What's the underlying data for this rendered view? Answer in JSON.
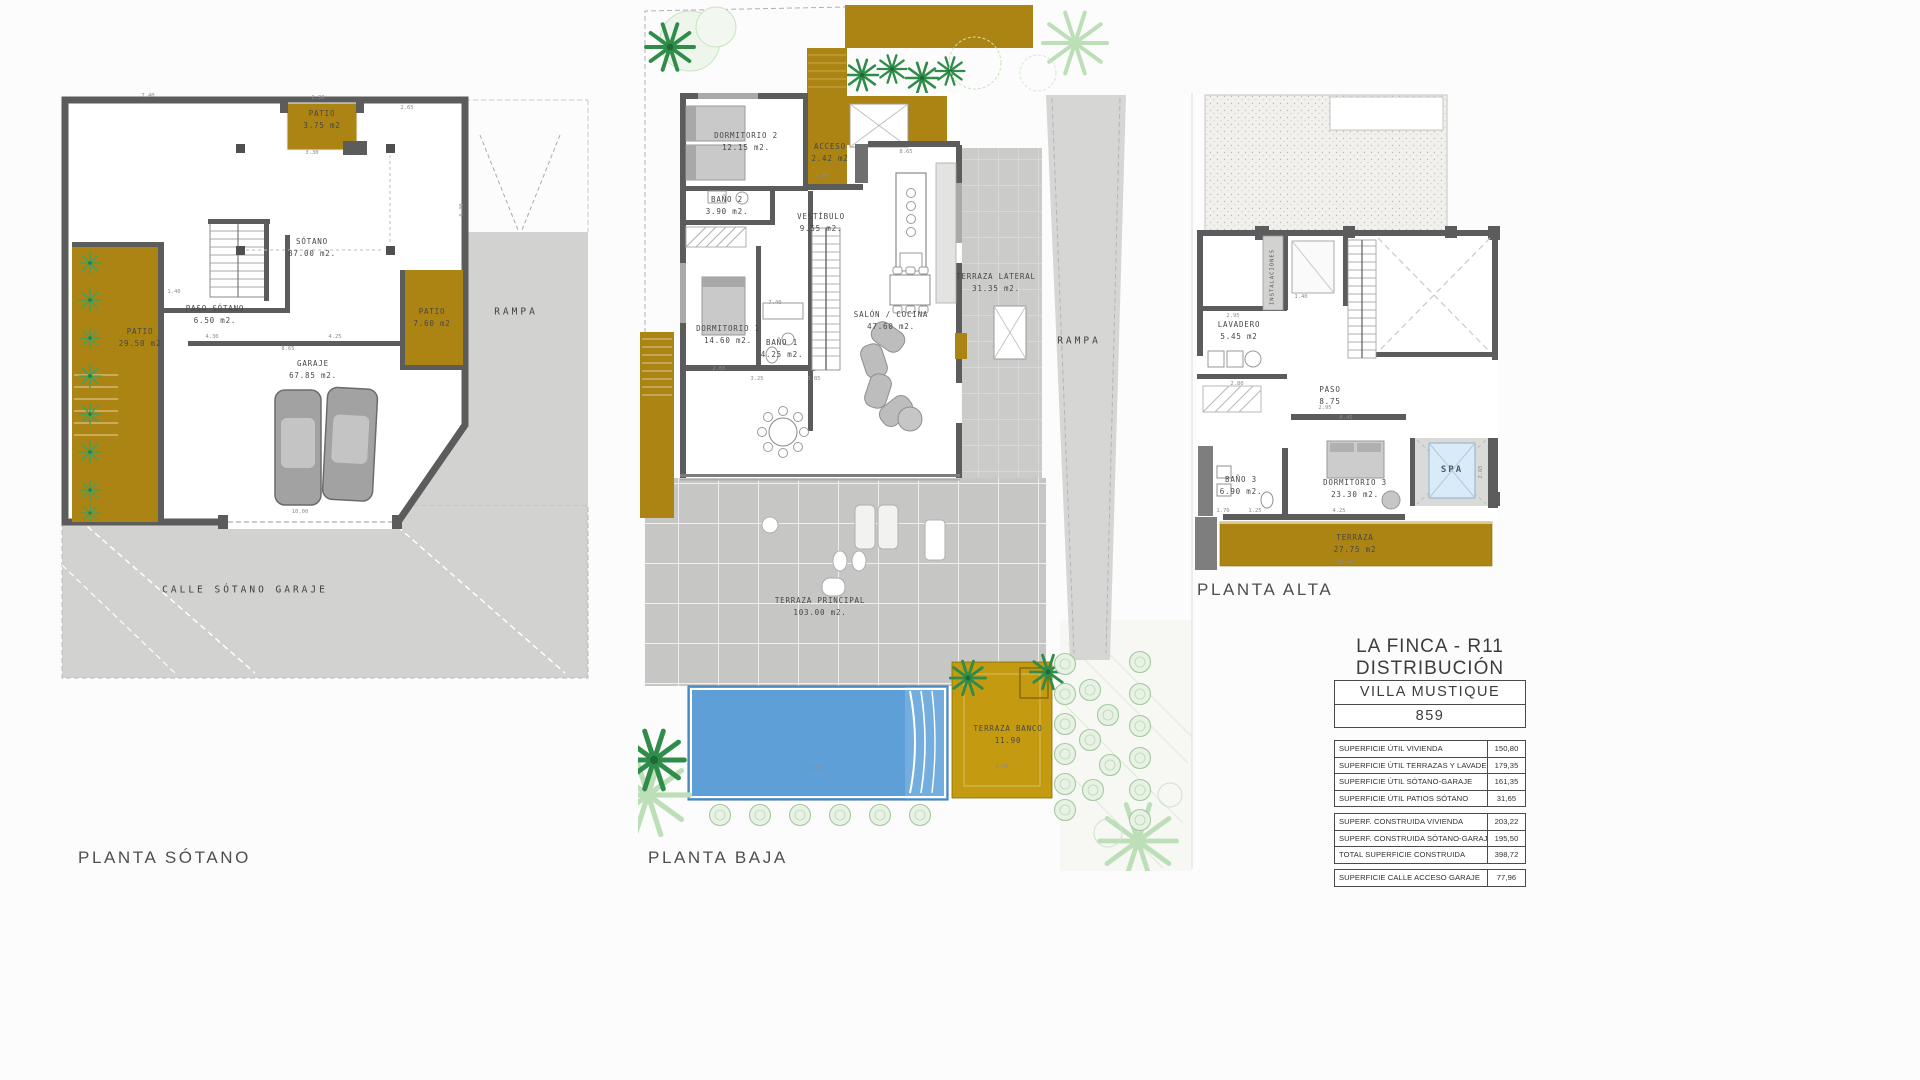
{
  "colors": {
    "ochre": "#ab8414",
    "ochre_bright": "#c49a10",
    "wall_gray": "#5c5c5c",
    "area_gray": "#d2d2d0",
    "tile_gray": "#c6c6c4",
    "pool_blue": "#5f9fd8",
    "spa_blue": "#d9ebf8",
    "plant_green": "#2f8c49",
    "text": "#3f3f3f"
  },
  "plans": {
    "sotano": {
      "title": "PLANTA SÓTANO",
      "rooms": {
        "patio_top": {
          "name": "PATIO",
          "area": "3.75 m2"
        },
        "sotano": {
          "name": "SÓTANO",
          "area": "87.00 m2."
        },
        "paso": {
          "name": "PASO SÓTANO",
          "area": "6.50 m2."
        },
        "patio_left": {
          "name": "PATIO",
          "area": "29.50 m2"
        },
        "patio_right": {
          "name": "PATIO",
          "area": "7.60 m2"
        },
        "garaje": {
          "name": "GARAJE",
          "area": "67.85 m2."
        },
        "rampa": {
          "name": "RAMPA"
        },
        "calle": {
          "name": "CALLE SÓTANO GARAJE"
        }
      }
    },
    "baja": {
      "title": "PLANTA BAJA",
      "rooms": {
        "dormitorio2": {
          "name": "DORMITORIO 2",
          "area": "12.15 m2."
        },
        "acceso": {
          "name": "ACCESO",
          "area": "2.42 m2"
        },
        "bano2": {
          "name": "BAÑO 2",
          "area": "3.90 m2."
        },
        "vestibulo": {
          "name": "VESTÍBULO",
          "area": "9.55 m2."
        },
        "dormitorio1": {
          "name": "DORMITORIO 1",
          "area": "14.60 m2."
        },
        "bano1": {
          "name": "BAÑO 1",
          "area": "4.25 m2."
        },
        "salon": {
          "name": "SALÓN / COCINA",
          "area": "47.60 m2."
        },
        "terraza_lateral": {
          "name": "TERRAZA LATERAL",
          "area": "31.35 m2."
        },
        "rampa": {
          "name": "RAMPA"
        },
        "terraza_principal": {
          "name": "TERRAZA PRINCIPAL",
          "area": "103.00 m2."
        },
        "terraza_banco": {
          "name": "TERRAZA BANCO",
          "area": "11.90"
        }
      }
    },
    "alta": {
      "title": "PLANTA ALTA",
      "rooms": {
        "instalaciones": {
          "name": "INSTALACIONES"
        },
        "lavadero": {
          "name": "LAVADERO",
          "area": "5.45 m2"
        },
        "paso": {
          "name": "PASO",
          "area": "8.75"
        },
        "bano3": {
          "name": "BAÑO 3",
          "area": "6.90 m2."
        },
        "dormitorio3": {
          "name": "DORMITORIO 3",
          "area": "23.30 m2."
        },
        "spa": {
          "name": "SPA"
        },
        "terraza": {
          "name": "TERRAZA",
          "area": "27.75 m2"
        }
      }
    }
  },
  "title_block": {
    "project": "LA FINCA - R11",
    "subtitle": "DISTRIBUCIÓN",
    "villa_name": "VILLA  MUSTIQUE",
    "villa_number": "859",
    "util_table": {
      "rows": [
        {
          "label": "SUPERFICIE ÚTIL VIVIENDA",
          "value": "150,80"
        },
        {
          "label": "SUPERFICIE ÚTIL TERRAZAS Y LAVADERO",
          "value": "179,35"
        },
        {
          "label": "SUPERFICIE ÚTIL SÓTANO-GARAJE",
          "value": "161,35"
        },
        {
          "label": "SUPERFICIE ÚTIL PATIOS SÓTANO",
          "value": "31,65"
        }
      ]
    },
    "construida_table": {
      "rows": [
        {
          "label": "SUPERF. CONSTRUIDA VIVIENDA",
          "value": "203,22"
        },
        {
          "label": "SUPERF. CONSTRUIDA SÓTANO-GARAJE",
          "value": "195,50"
        },
        {
          "label": "TOTAL SUPERFICIE CONSTRUIDA",
          "value": "398,72"
        }
      ]
    },
    "calle_table": {
      "rows": [
        {
          "label": "SUPERFICIE CALLE ACCESO GARAJE",
          "value": "77,96"
        }
      ]
    }
  },
  "dims": [
    {
      "t": "7.40",
      "x": 148,
      "y": 96
    },
    {
      "t": "2.30",
      "x": 318,
      "y": 98
    },
    {
      "t": "2.65",
      "x": 407,
      "y": 108
    },
    {
      "t": "3.30",
      "x": 312,
      "y": 153
    },
    {
      "t": "1.40",
      "x": 174,
      "y": 292
    },
    {
      "t": "4.30",
      "x": 212,
      "y": 337
    },
    {
      "t": "4.25",
      "x": 335,
      "y": 337
    },
    {
      "t": "8.65",
      "x": 288,
      "y": 349
    },
    {
      "t": "10.00",
      "x": 300,
      "y": 512
    },
    {
      "t": "6.30",
      "x": 462,
      "y": 210,
      "v": true
    },
    {
      "t": "8.65",
      "x": 906,
      "y": 152
    },
    {
      "t": "1.60",
      "x": 822,
      "y": 176
    },
    {
      "t": "7.40",
      "x": 775,
      "y": 303
    },
    {
      "t": "2.65",
      "x": 719,
      "y": 369
    },
    {
      "t": "3.25",
      "x": 757,
      "y": 379
    },
    {
      "t": "3.05",
      "x": 814,
      "y": 379
    },
    {
      "t": "9.60",
      "x": 815,
      "y": 769
    },
    {
      "t": "5.40",
      "x": 1002,
      "y": 767
    },
    {
      "t": "2.95",
      "x": 1233,
      "y": 316
    },
    {
      "t": "1.40",
      "x": 1301,
      "y": 297
    },
    {
      "t": "2.80",
      "x": 1237,
      "y": 384
    },
    {
      "t": "2.95",
      "x": 1325,
      "y": 408
    },
    {
      "t": "4.45",
      "x": 1346,
      "y": 418
    },
    {
      "t": "1.70",
      "x": 1223,
      "y": 511
    },
    {
      "t": "1.25",
      "x": 1255,
      "y": 511
    },
    {
      "t": "4.25",
      "x": 1339,
      "y": 511
    },
    {
      "t": "10.20",
      "x": 1345,
      "y": 562
    },
    {
      "t": "2.65",
      "x": 1481,
      "y": 472,
      "v": true
    }
  ]
}
